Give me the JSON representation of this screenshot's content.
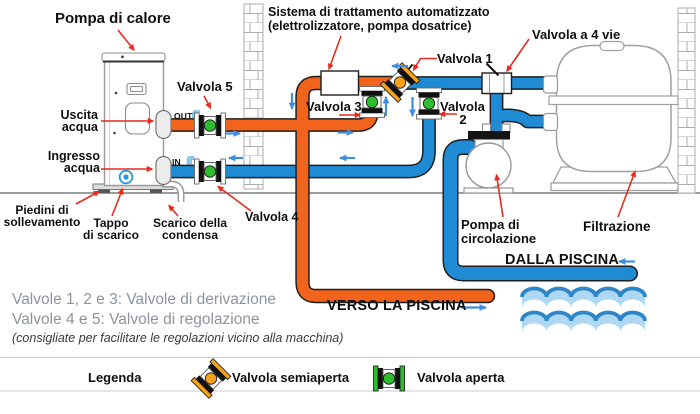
{
  "colors": {
    "pipe_hot": "#F2641C",
    "pipe_cold": "#1E8BD4",
    "valve_open": "#2DBE2D",
    "valve_semi": "#F6A21B",
    "flow_arrow": "#3E8EE0",
    "pointer_red": "#E62B1E",
    "wave_light": "#AFD8F4",
    "wave_dark": "#2C86C7",
    "note_gray": "#8C94A0"
  },
  "diagram": {
    "labels": {
      "heat_pump": "Pompa di calore",
      "treatment_system_line1": "Sistema di trattamento automatizzato",
      "treatment_system_line2": "(elettrolizzatore, pompa dosatrice)",
      "four_way_valve": "Valvola a 4 vie",
      "valve_1": "Valvola 1",
      "valve_2_word": "Valvola",
      "valve_2_num": "2",
      "valve_3": "Valvola 3",
      "valve_4": "Valvola 4",
      "valve_5": "Valvola 5",
      "water_outlet": "Uscita\nacqua",
      "water_inlet": "Ingresso\nacqua",
      "out_port": "OUT",
      "in_port": "IN",
      "lifting_feet": "Piedini di\nsollevamento",
      "drain_plug": "Tappo\ndi scarico",
      "condensate_drain": "Scarico della\ncondensa",
      "circulation_pump": "Pompa di\ncircolazione",
      "filtration": "Filtrazione",
      "from_pool": "DALLA PISCINA",
      "to_pool": "VERSO LA PISCINA"
    },
    "notes": {
      "line1": "Valvole 1, 2 e 3: Valvole di derivazione",
      "line2": "Valvole 4 e 5: Valvole di regolazione",
      "line3": "(consigliate per facilitare le regolazioni vicino alla macchina)"
    },
    "legend": {
      "title": "Legenda",
      "semi_open_label": "Valvola semiaperta",
      "open_label": "Valvola aperta"
    }
  }
}
